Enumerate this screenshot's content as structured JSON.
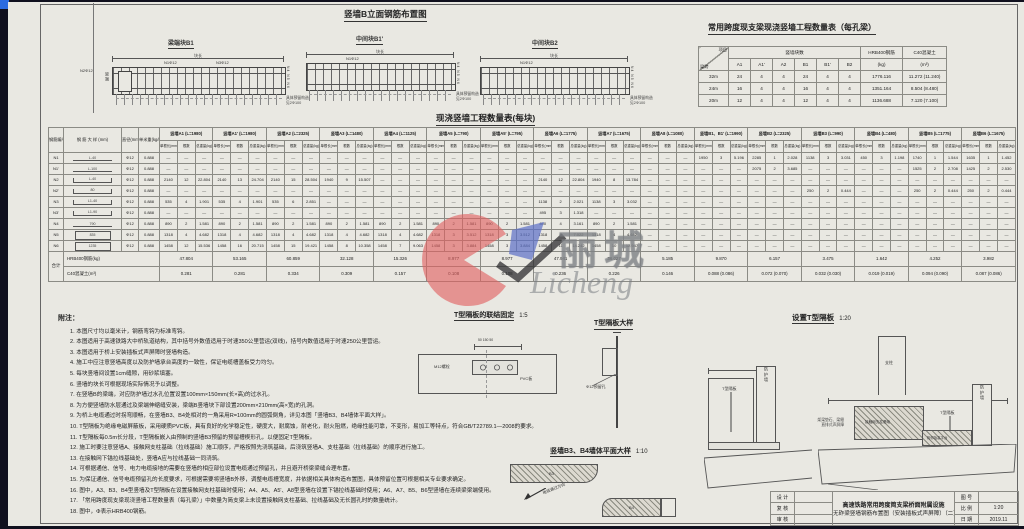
{
  "colors": {
    "paper": "#e9e8e2",
    "line": "#555555",
    "accent_blue": "#2b6be0",
    "wm_red": "#e06060",
    "wm_blue": "#5b6fc8"
  },
  "elevation": {
    "title": "竖墙B立面钢筋布置图",
    "diagrams": [
      {
        "name": "梁端块B1",
        "dim_label": "块长",
        "top1": "N1Φ12",
        "top2": "N3Φ12",
        "left1": "N2Φ12",
        "side": "梁端",
        "right": "N4 N5 N6",
        "note1": "具体预留构造",
        "note2": "见2Φ100"
      },
      {
        "name": "中间块B1'",
        "dim_label": "块长",
        "top1": "N1Φ12",
        "right": "N4 N5 N6",
        "note1": "具体预留构造",
        "note2": "见2Φ100"
      },
      {
        "name": "中间块B2",
        "dim_label": "块长",
        "top1": "N1Φ12",
        "right": "N4 N5 N6",
        "note1": "具体预留构造",
        "note2": "见2Φ100"
      }
    ]
  },
  "span_table": {
    "title": "常用跨度现支梁现浇竖墙工程数量表（每孔梁）",
    "corner_top": "项目",
    "corner_bottom": "梁跨",
    "group_header": "竖墙块数",
    "block_cols": [
      "A1",
      "A1'",
      "A2",
      "B1",
      "B1'",
      "B2"
    ],
    "steel_header": "HRB400钢筋",
    "steel_unit": "(kg)",
    "concrete_header": "C40混凝土",
    "concrete_unit": "(m³)",
    "rows": [
      {
        "span": "32m",
        "blocks": [
          "24",
          "4",
          "4",
          "24",
          "4",
          "4"
        ],
        "steel": "1776.116",
        "concrete": "11.272 (11.240)"
      },
      {
        "span": "24m",
        "blocks": [
          "16",
          "4",
          "4",
          "16",
          "4",
          "4"
        ],
        "steel": "1351.164",
        "concrete": "8.504 (8.480)"
      },
      {
        "span": "20m",
        "blocks": [
          "12",
          "4",
          "4",
          "12",
          "4",
          "4"
        ],
        "steel": "1136.688",
        "concrete": "7.120 (7.100)"
      }
    ]
  },
  "main_table": {
    "title": "现浇竖墙工程数量表(每块)",
    "headers": {
      "id": "钢筋编号",
      "sketch": "钢 筋 大 样 (mm)",
      "dia": "直径(mm)",
      "unit": "单米重(kg/m)",
      "len": "单根长(mm)",
      "count": "根数",
      "weight": "总重量(kg)"
    },
    "groups": [
      "竖墙A1 (L=1980)",
      "竖墙A1' (L=1980)",
      "竖墙A2 (L=2325)",
      "竖墙A3 (L=1480)",
      "竖墙A4 (L=1125)",
      "竖墙A5 (L=790)",
      "竖墙A5' (L=795)",
      "竖墙A6 (L=1775)",
      "竖墙A7 (L=1675)",
      "竖墙A8 (L=1080)",
      "竖墙B1、B1' (L=1990)",
      "竖墙B2 (L=2325)",
      "竖墙B3 (L=990)",
      "竖墙B4 (L=480)",
      "竖墙B5 (L=1775)",
      "竖墙B6 (L=1675)"
    ],
    "rows": [
      {
        "id": "N1",
        "dia": "Φ12",
        "unit": "0.888",
        "sketch": {
          "type": "line",
          "dim": "L-40"
        },
        "cells": [
          null,
          null,
          null,
          null,
          null,
          null,
          null,
          null,
          null,
          null,
          [
            "1950",
            "3",
            "5.196"
          ],
          [
            "2285",
            "1",
            "2.028"
          ],
          [
            "1138",
            "3",
            "3.031"
          ],
          [
            "450",
            "3",
            "1.198"
          ],
          [
            "1740",
            "1",
            "1.544"
          ],
          [
            "1635",
            "1",
            "1.452"
          ]
        ]
      },
      {
        "id": "N1'",
        "dia": "Φ12",
        "unit": "0.888",
        "sketch": {
          "type": "line",
          "dim": "L-100"
        },
        "cells": [
          null,
          null,
          null,
          null,
          null,
          null,
          null,
          null,
          null,
          null,
          null,
          [
            "2075",
            "2",
            "3.685"
          ],
          null,
          null,
          [
            "1525",
            "2",
            "2.708"
          ],
          [
            "1425",
            "2",
            "2.530"
          ]
        ]
      },
      {
        "id": "N2",
        "dia": "Φ12",
        "unit": "0.888",
        "sketch": {
          "type": "hook",
          "dim": "L-40"
        },
        "cells": [
          [
            "2140",
            "12",
            "22.804"
          ],
          [
            "2140",
            "13",
            "24.704"
          ],
          [
            "2140",
            "15",
            "28.504"
          ],
          [
            "1940",
            "9",
            "15.507"
          ],
          null,
          null,
          null,
          [
            "2140",
            "12",
            "22.804"
          ],
          [
            "1940",
            "8",
            "13.784"
          ],
          null,
          null,
          null,
          null,
          null,
          null,
          null
        ]
      },
      {
        "id": "N2'",
        "dia": "Φ12",
        "unit": "0.888",
        "sketch": {
          "type": "hook",
          "dim": "80"
        },
        "cells": [
          null,
          null,
          null,
          null,
          null,
          null,
          null,
          null,
          null,
          null,
          null,
          null,
          [
            "250",
            "2",
            "0.444"
          ],
          null,
          [
            "250",
            "2",
            "0.444"
          ],
          [
            "250",
            "2",
            "0.444"
          ]
        ]
      },
      {
        "id": "N3",
        "dia": "Φ12",
        "unit": "0.888",
        "sketch": {
          "type": "hook",
          "dim": "L1-40"
        },
        "cells": [
          [
            "535",
            "4",
            "1.901"
          ],
          [
            "535",
            "4",
            "1.901"
          ],
          [
            "535",
            "6",
            "2.851"
          ],
          null,
          null,
          null,
          null,
          [
            "1138",
            "2",
            "2.021"
          ],
          [
            "1138",
            "3",
            "3.032"
          ],
          null,
          null,
          null,
          null,
          null,
          null,
          null
        ]
      },
      {
        "id": "N3'",
        "dia": "Φ12",
        "unit": "0.888",
        "sketch": {
          "type": "hook",
          "dim": "L1-90"
        },
        "cells": [
          null,
          null,
          null,
          null,
          null,
          null,
          null,
          [
            "495",
            "3",
            "1.318"
          ],
          null,
          null,
          null,
          null,
          null,
          null,
          null,
          null
        ]
      },
      {
        "id": "N4",
        "dia": "Φ12",
        "unit": "0.888",
        "sketch": {
          "type": "line",
          "dim": "790"
        },
        "cells": [
          [
            "890",
            "2",
            "1.581"
          ],
          [
            "890",
            "2",
            "1.581"
          ],
          [
            "890",
            "2",
            "1.581"
          ],
          [
            "890",
            "2",
            "1.581"
          ],
          [
            "890",
            "2",
            "1.581"
          ],
          [
            "890",
            "2",
            "1.581"
          ],
          [
            "890",
            "2",
            "1.581"
          ],
          [
            "890",
            "4",
            "3.161"
          ],
          [
            "890",
            "2",
            "1.581"
          ],
          null,
          null,
          null,
          null,
          null,
          null,
          null
        ]
      },
      {
        "id": "N5",
        "dia": "Φ12",
        "unit": "0.888",
        "sketch": {
          "type": "rect",
          "dim": "835"
        },
        "cells": [
          [
            "1318",
            "4",
            "4.682"
          ],
          [
            "1318",
            "4",
            "4.682"
          ],
          [
            "1318",
            "4",
            "4.682"
          ],
          [
            "1318",
            "4",
            "4.682"
          ],
          [
            "1318",
            "4",
            "4.682"
          ],
          [
            "1318",
            "3",
            "3.512"
          ],
          [
            "1318",
            "3",
            "3.512"
          ],
          [
            "1318",
            "6",
            "7.022"
          ],
          [
            "1318",
            "4",
            "4.682"
          ],
          null,
          null,
          null,
          null,
          null,
          null,
          null
        ]
      },
      {
        "id": "N6",
        "dia": "Φ12",
        "unit": "0.888",
        "sketch": {
          "type": "rect",
          "dim": "1235"
        },
        "cells": [
          [
            "1458",
            "12",
            "15.536"
          ],
          [
            "1458",
            "16",
            "20.715"
          ],
          [
            "1458",
            "15",
            "19.421"
          ],
          [
            "1458",
            "8",
            "10.358"
          ],
          [
            "1458",
            "7",
            "9.063"
          ],
          [
            "1458",
            "3",
            "3.884"
          ],
          [
            "1458",
            "3",
            "3.884"
          ],
          [
            "1458",
            "11",
            "14.242"
          ],
          [
            "1458",
            "10",
            "12.947"
          ],
          null,
          null,
          null,
          null,
          null,
          null,
          null
        ]
      }
    ],
    "totals": {
      "label": "合计",
      "steel_label": "HRB400钢筋(kg)",
      "concrete_label": "C40混凝土(m³)",
      "steel": [
        "47.804",
        "53.165",
        "60.859",
        "32.128",
        "15.326",
        "8.977",
        "8.977",
        "47.941",
        "36.027",
        "5.185",
        "9.870",
        "6.157",
        "3.475",
        "1.642",
        "4.252",
        "3.982"
      ],
      "concrete": [
        "0.281",
        "0.281",
        "0.334",
        "0.309",
        "0.157",
        "0.108",
        "0.108",
        "0.236",
        "0.226",
        "0.146",
        "0.088 (0.086)",
        "0.072 (0.070)",
        "0.032 (0.030)",
        "0.019 (0.019)",
        "0.094 (0.090)",
        "0.087 (0.086)"
      ]
    }
  },
  "notes": {
    "title": "附注：",
    "items": [
      "1. 本图尺寸均以毫米计，钢筋弯钩为标准弯钩。",
      "2. 本图适用于高速铁路大中桥轨道结构，其中括号外数值适用于时速350公里营运(双线)，括号内数值适用于时速250公里营运。",
      "3. 本图适用于桥上安装插板式声屏障时竖墙构造。",
      "4. 施工中应注意竖墙高度以及防护墙承台高度的一致性，保证电缆槽盖板受力均匀。",
      "5. 每块竖墙间设置1cm缝隙，用砂浆填塞。",
      "6. 竖墙的块长可根据现场实际情况予以调整。",
      "7. 在竖墙B的梁端，对应防护墙过水孔位置设置100mm×150mm(长×高)的过水孔。",
      "8. 为方便竖墙防水层通过及梁端伸缩缝安装，梁端B竖墙块下部设置200mm×210mm(高×宽)的孔洞。",
      "9. 为桥上电缆通过时拐弯顺畅，在竖墙B3、B4处相对的一角采用R=100mm的圆弧倒角，详见本图「竖墙B3、B4墙体平面大样」。",
      "10. T型隔板为绝缘电磁屏蔽板，采用硬质PVC板，具有良好的化学稳定性，硬度大，耐腐蚀，耐老化，耐火阻燃，绝缘性能可靠，不变形，易加工等特点，符合GB/T22789.1—2008的要求。",
      "11. T型隔板每0.5m长分段，T型隔板嵌入由预制的竖墙B3预留的预留槽楔形孔，以便固定T型隔板。",
      "12. 施工时要注意竖墙A、接触网支柱基础（拉线基础）施工顺序，严格按照先浇筑基础，后浇筑竖墙A、支柱基础（拉线基础）的顺序进行施工。",
      "13. 在接触网下锚拉线基础处，竖墙A应与拉线基础一同浇筑。",
      "14. 可根据通信、信号、电力电缆接地的需要在竖墙的相应部位设置电缆通过预留孔，并且避开桥梁梁缝合理布置。",
      "15. 为保证通信、信号电缆预留孔的长度要求，可根据需要将竖墙B外移，调整电缆槽宽度，并依据相关具体构造布置图，具体预留位置可根据相关专业要求确定。",
      "16. 图中，A3、B3、B4型竖墙及T型隔板在设置接触网支柱基础时使用；A4、A5、A5'、A8型竖墙在设置下锚拉线基础时使用；A6、A7、B5、B6型竖墙在连续梁梁端使用。",
      "17. 「常用跨度现支梁现浇竖墙工程数量表（每孔梁）」中数量为简支梁上未设置接触网支柱基础、拉线基础及无长圆孔时的数量统计。",
      "18. 图中，Φ表示HRB400钢筋。"
    ]
  },
  "details": {
    "fix": {
      "title": "T型隔板的联结固定",
      "scale": "1:5",
      "bolt": "M12螺栓",
      "pvc": "PVC板",
      "dims": "50  150  50"
    },
    "plate": {
      "title": "T型隔板大样",
      "hole": "Φ12预留孔"
    },
    "plan": {
      "title": "竖墙B3、B4墙体平面大样",
      "scale": "1:10",
      "arrow": "电缆通过方向",
      "tag1": "B3",
      "tag2": "B4"
    },
    "install": {
      "title": "设置T型隔板",
      "scale": "1:20",
      "post": "支柱",
      "foundation": "接触网支柱基础",
      "plate": "T型隔板",
      "plate2": "T型隔板",
      "wall": "防护墙",
      "wall2": "防护墙",
      "platform": "相邻抬高平台",
      "note1": "架梁垫石、梁缝",
      "note2": "直排式声屏障"
    }
  },
  "title_block": {
    "left_rows": [
      "设 计",
      "复 核",
      "审 核"
    ],
    "title_line1": "高速铁路常用跨度简支梁桥面附属设施",
    "title_line2": "无砟梁竖墙钢筋布置图（安装插板式声屏障）（二）",
    "right_rows": [
      {
        "label": "图 号",
        "value": ""
      },
      {
        "label": "比 例",
        "value": "1:20"
      },
      {
        "label": "日 期",
        "value": "2019.11"
      }
    ]
  },
  "watermark": {
    "cn": "丽城",
    "en": "Licheng"
  }
}
